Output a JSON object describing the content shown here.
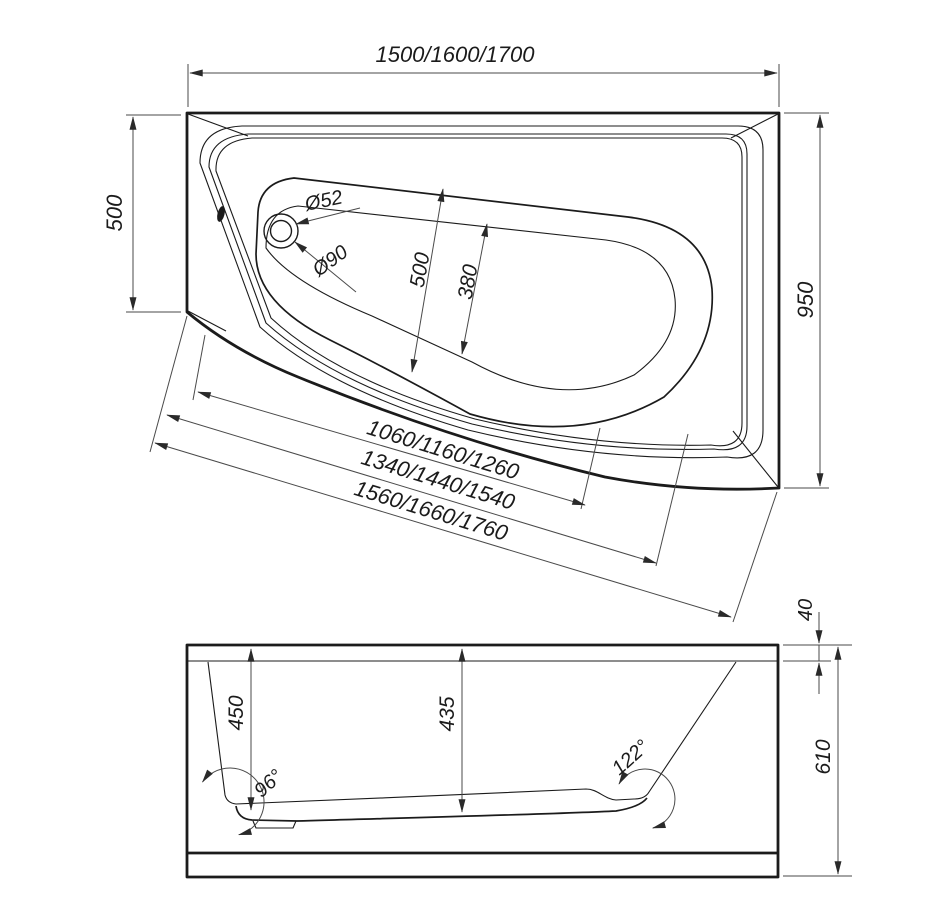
{
  "drawing": {
    "type": "bathtub technical drawing, top view and front view",
    "colors": {
      "background": "#ffffff",
      "line": "#1b1b1b",
      "dimension_line": "#4a4a4a"
    },
    "top_view": {
      "length_options": "1500/1600/1700",
      "left_end_width": "500",
      "overall_width": "950",
      "basin_inner_width": "500",
      "floor_width": "380",
      "drain_hole_diameter": "Ø52",
      "drain_flange_diameter": "Ø90",
      "diagonal_inner_length_options": "1060/1160/1260",
      "diagonal_middle_length_options": "1340/1440/1540",
      "diagonal_outer_length_options": "1560/1660/1760"
    },
    "side_view": {
      "rim_height": "40",
      "depth_left": "450",
      "depth_center": "435",
      "overall_height": "610",
      "left_wall_angle": "96°",
      "right_wall_angle": "122°"
    }
  }
}
